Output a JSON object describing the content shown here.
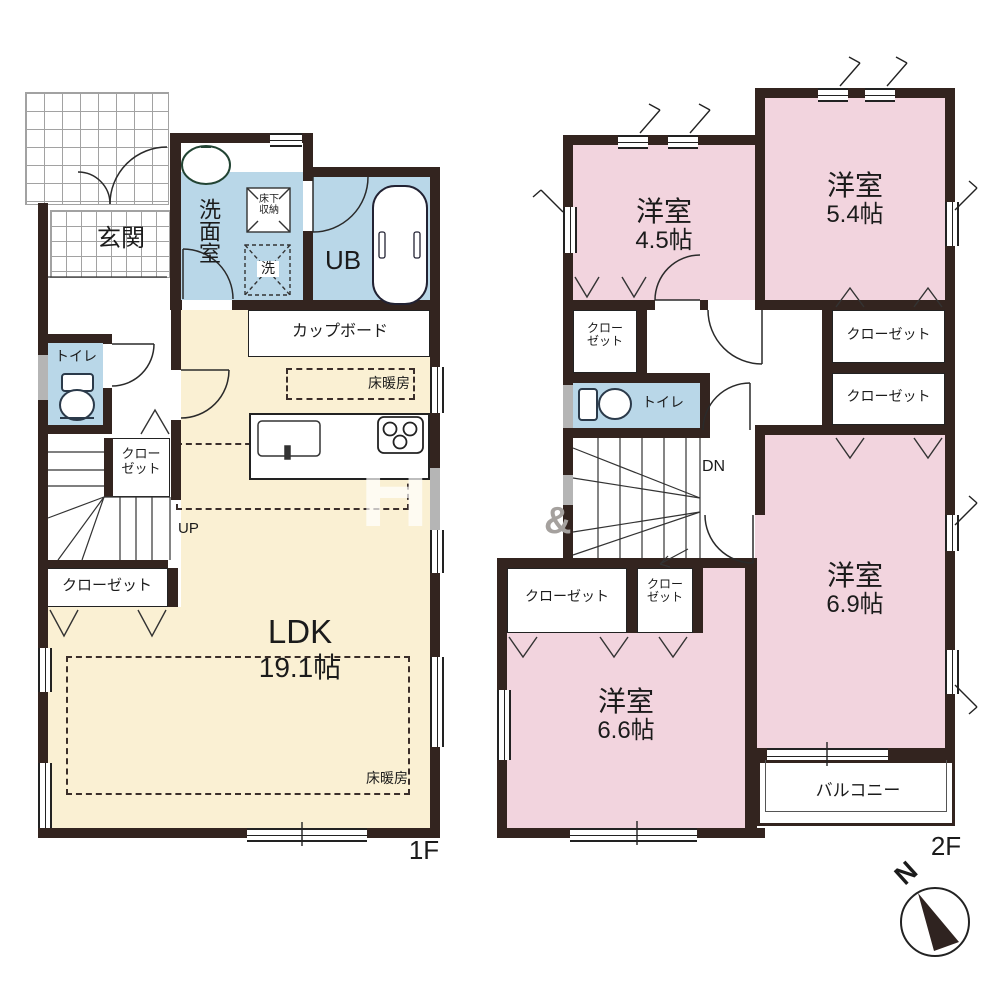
{
  "floor_1f": {
    "floor_label": "1F",
    "entrance_label": "玄関",
    "washroom_label": "洗面室",
    "underfloor_storage_label_line1": "床下",
    "underfloor_storage_label_line2": "収納",
    "washer_label": "洗",
    "unit_bath_label": "UB",
    "toilet_label": "トイレ",
    "cupboard_label": "カップボード",
    "floor_heating_kitchen_label": "床暖房",
    "floor_heating_living_label": "床暖房",
    "hall_closet_label_line1": "クロー",
    "hall_closet_label_line2": "ゼット",
    "ldk_closet_label": "クローゼット",
    "ldk_name": "LDK",
    "ldk_size": "19.1帖",
    "stairs_up_label": "UP"
  },
  "floor_2f": {
    "floor_label": "2F",
    "room_nw_name": "洋室",
    "room_nw_size": "4.5帖",
    "room_ne_name": "洋室",
    "room_ne_size": "5.4帖",
    "room_se_name": "洋室",
    "room_se_size": "6.9帖",
    "room_sw_name": "洋室",
    "room_sw_size": "6.6帖",
    "closet_ne_upper_label": "クローゼット",
    "closet_ne_lower_label": "クローゼット",
    "closet_nw_label_line1": "クロー",
    "closet_nw_label_line2": "ゼット",
    "closet_sw_wide_label": "クローゼット",
    "closet_sw_small_label_line1": "クロー",
    "closet_sw_small_label_line2": "ゼット",
    "toilet_label": "トイレ",
    "stairs_down_label": "DN",
    "balcony_label": "バルコニー"
  },
  "compass": {
    "north_label": "N"
  },
  "watermark": {
    "letter_1": "H",
    "letter_2": "i",
    "letter_3": "&"
  },
  "colors": {
    "wall": "#33241f",
    "room_pink": "#f2d4de",
    "room_blue": "#b9d7e8",
    "room_beige": "#faf0d3",
    "window_gray": "#b5b5b5"
  }
}
